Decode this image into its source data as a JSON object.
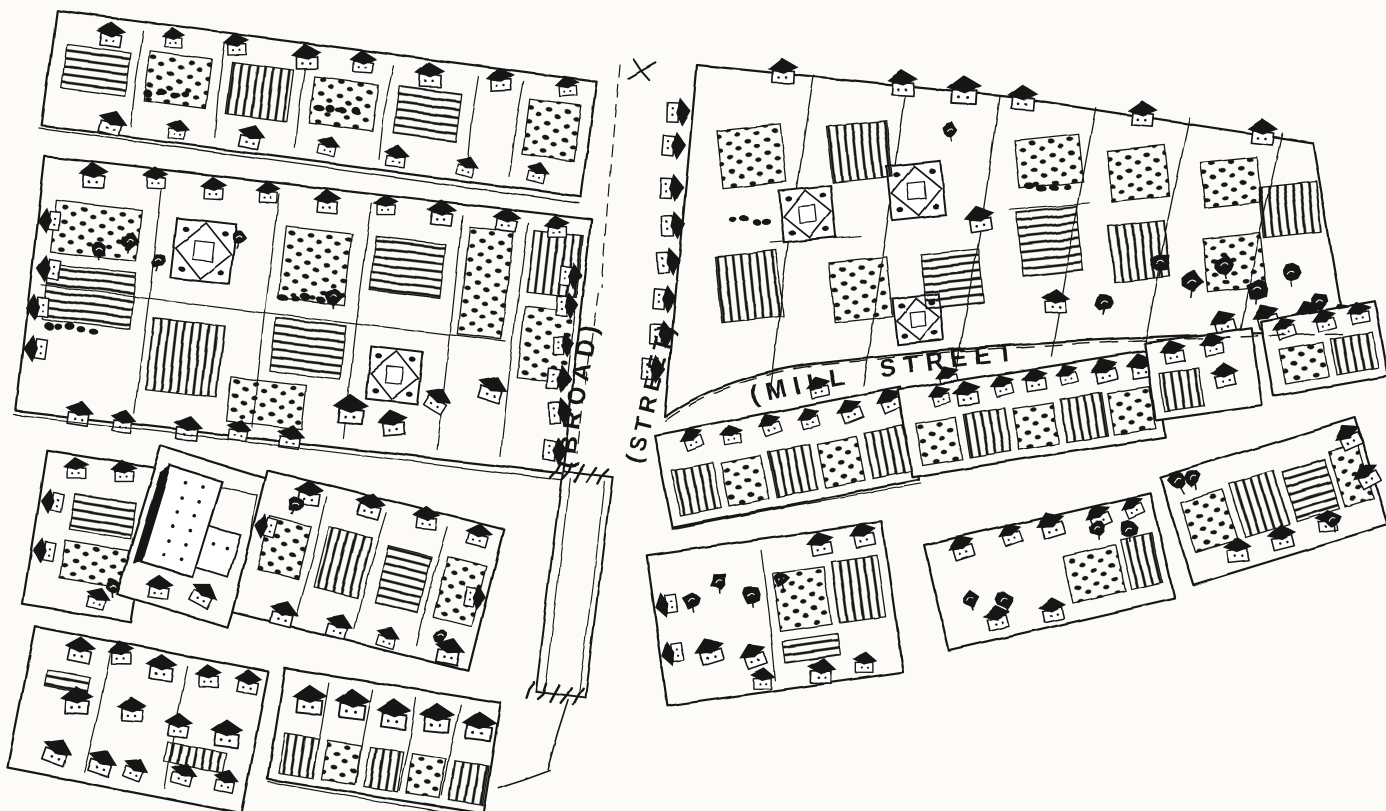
{
  "map": {
    "type": "hand-drawn bird's-eye pictorial town map (pen and ink engraving)",
    "background_color": "#fcfbf8",
    "ink_color": "#181818",
    "streets": [
      {
        "id": "broad-street",
        "label_parts": [
          "(BROAD)",
          "(STREET)"
        ],
        "orientation": "vertical"
      },
      {
        "id": "mill-street",
        "label": "(MILL STREET)",
        "orientation": "curved-horizontal"
      }
    ],
    "visible_elements": [
      "city blocks of small gabled houses with dark roofs",
      "fenced house lots",
      "garden plots with planted crop rows",
      "square knot gardens",
      "orchard trees and bush rows",
      "footbridge crossing Broad Street"
    ]
  }
}
